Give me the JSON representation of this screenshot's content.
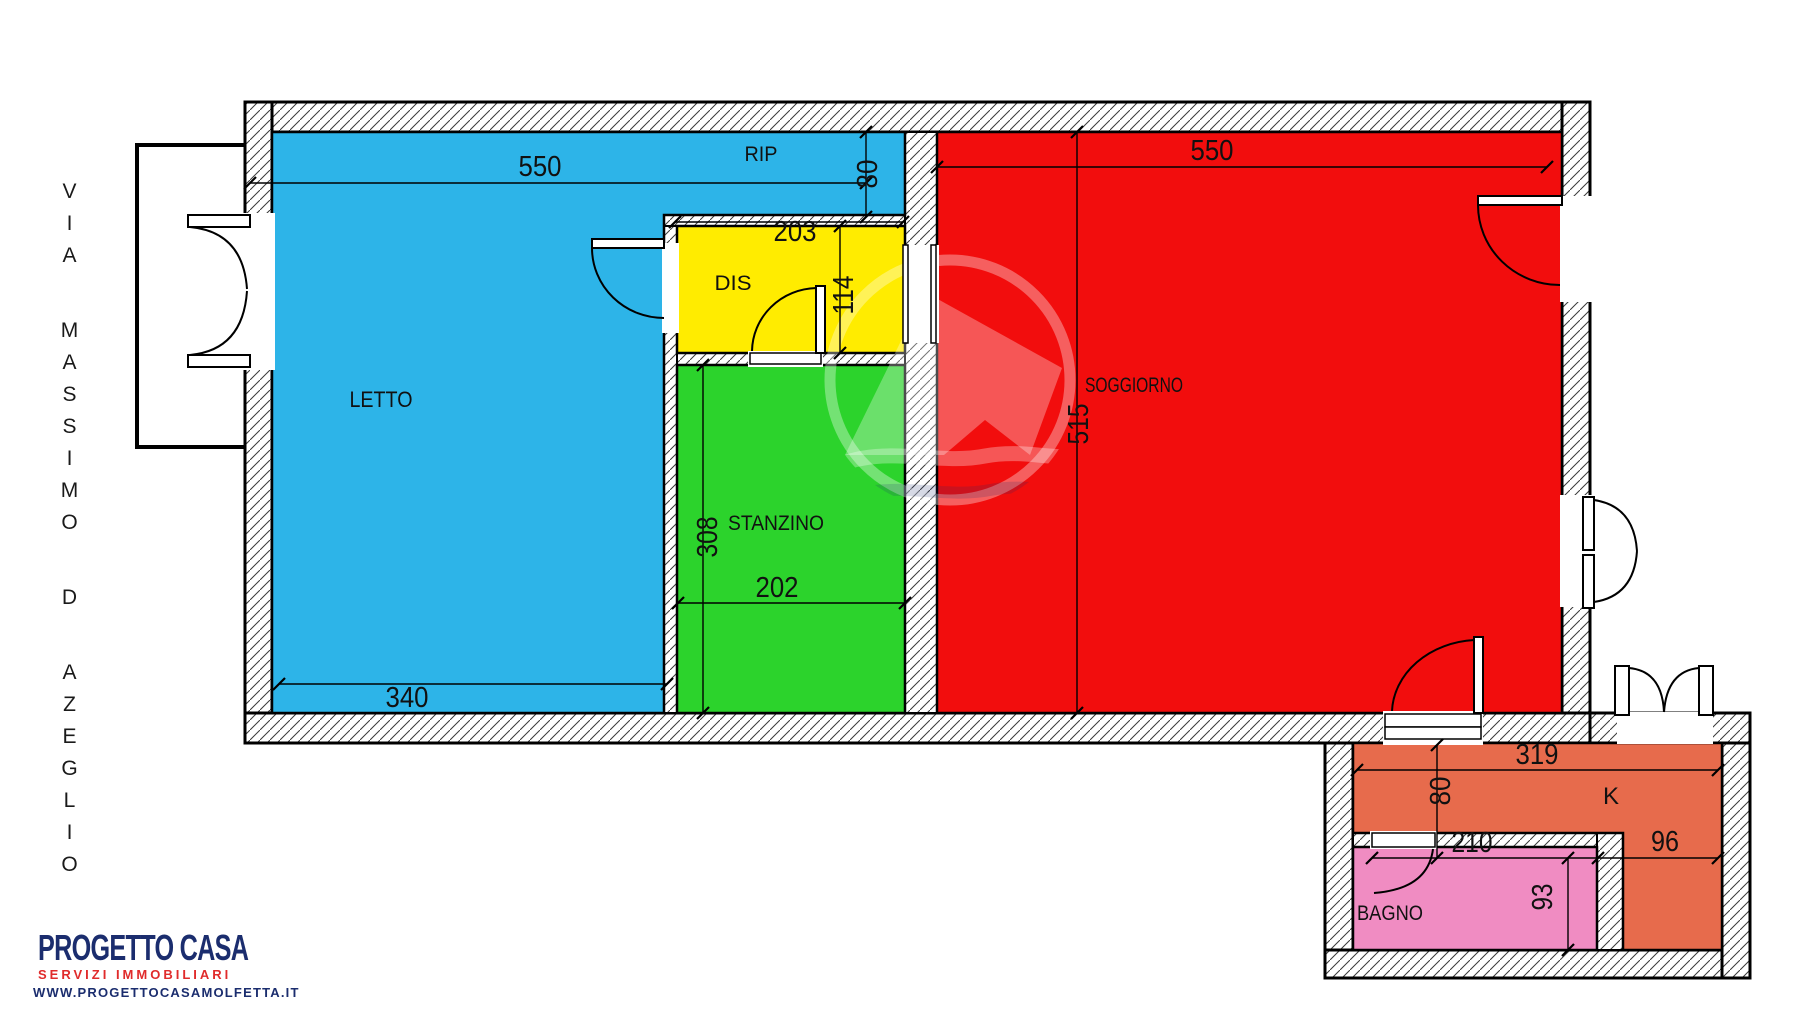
{
  "street": {
    "label": "VIA MASSIMO D AZEGLIO"
  },
  "rooms": {
    "letto": {
      "label": "LETTO",
      "color": "#2db4e8"
    },
    "rip": {
      "label": "RIP",
      "color": "#2db4e8"
    },
    "dis": {
      "label": "DIS",
      "color": "#ffec00"
    },
    "stanzino": {
      "label": "STANZINO",
      "color": "#2cd32c"
    },
    "soggiorno": {
      "label": "SOGGIORNO",
      "color": "#f20d0d"
    },
    "cucina": {
      "label": "K",
      "color": "#e76b4c"
    },
    "bagno": {
      "label": "BAGNO",
      "color": "#f08cc2"
    }
  },
  "dims": {
    "letto_rip_width": "550",
    "rip_depth": "80",
    "dis_width": "203",
    "dis_depth": "114",
    "letto_width": "340",
    "stanzino_depth": "308",
    "stanzino_width": "202",
    "soggiorno_width": "550",
    "soggiorno_depth": "515",
    "cucina_width": "319",
    "cucina_depth": "80",
    "bagno_width": "210",
    "cucina_side": "96",
    "bagno_depth": "93"
  },
  "logo": {
    "title": "PROGETTO CASA",
    "subtitle": "SERVIZI IMMOBILIARI",
    "website": "WWW.PROGETTOCASAMOLFETTA.IT",
    "navy": "#1b2d6e",
    "red": "#cf1f24"
  }
}
